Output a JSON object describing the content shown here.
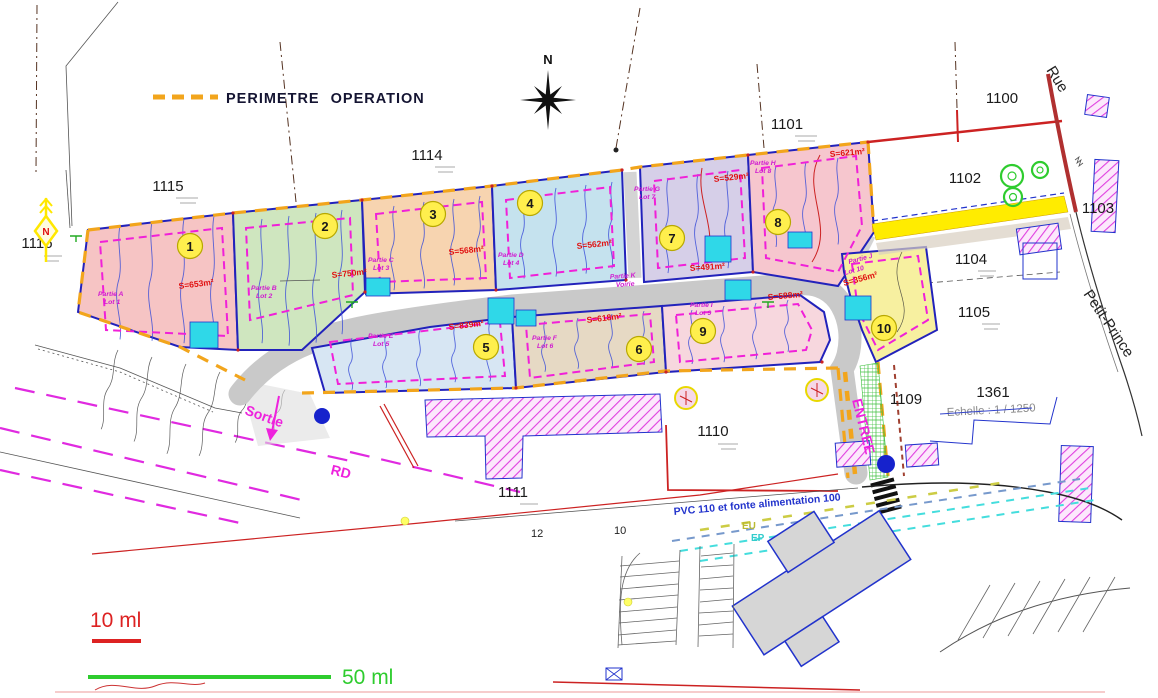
{
  "legend": {
    "label": "PERIMETRE OPERATION"
  },
  "compass": {
    "label": "N"
  },
  "north_marker": {
    "label": "N"
  },
  "scalebars": {
    "small": "10 ml",
    "large": "50 ml"
  },
  "texts": {
    "sortie": "Sortie",
    "entree": "ENTREE",
    "rd": "RD",
    "rue": "Rue",
    "petit_prince": "Petit-Prince",
    "pvc": "PVC 110 et fonte alimentation 100",
    "eu": "EU",
    "ep": "EP",
    "echelle": "Echelle : 1 / 1250",
    "n12": "12",
    "n10": "10"
  },
  "parcel_numbers": [
    "1115",
    "1116",
    "1114",
    "1101",
    "1100",
    "1102",
    "1103",
    "1104",
    "1105",
    "1361",
    "1109",
    "1110",
    "1111"
  ],
  "lots": [
    {
      "num": "1",
      "partie": "Partie A",
      "lot": "Lot 1",
      "area": "S=653m²",
      "color": "#f6c4c4"
    },
    {
      "num": "2",
      "partie": "Partie B",
      "lot": "Lot 2",
      "area": "S=750m²",
      "color": "#cfe6bf"
    },
    {
      "num": "3",
      "partie": "Partie C",
      "lot": "Lot 3",
      "area": "S=568m²",
      "color": "#f7d4b0"
    },
    {
      "num": "4",
      "partie": "Partie D",
      "lot": "Lot 4",
      "area": "S=562m²",
      "color": "#c5e2ee"
    },
    {
      "num": "5",
      "partie": "Partie E",
      "lot": "Lot 5",
      "area": "S=839m²",
      "color": "#d7e6f3"
    },
    {
      "num": "6",
      "partie": "Partie F",
      "lot": "Lot 6",
      "area": "S=618m²",
      "color": "#e6d9c4"
    },
    {
      "num": "7",
      "partie": "Partie G",
      "lot": "Lot 7",
      "area": "S=529m²",
      "color": "#d6cfe8"
    },
    {
      "num": "8",
      "partie": "Partie H",
      "lot": "Lot 8",
      "area": "S=621m²",
      "color": "#f6c6ce"
    },
    {
      "num": "9",
      "partie": "Partie I",
      "lot": "Lot 9",
      "area": "S=588m²",
      "color": "#f7d7de"
    },
    {
      "num": "10",
      "partie": "Partie J",
      "lot": "Lot 10",
      "area": "S=356m²",
      "color": "#f7f0a0"
    }
  ],
  "voirie": {
    "partie": "Partie K",
    "name": "Voirie",
    "area": "S=491m²"
  },
  "colors": {
    "perimeter_dash": "#f2a51c",
    "zone_dash": "#f020d8",
    "lot_outline": "#2222bb",
    "road_fill": "#c9c9c9",
    "scale_small": "#dd2222",
    "scale_large": "#2ecc2e",
    "yellow_road": "#ffec00",
    "tree_green": "#2ecc2e",
    "building_hatch": "#e040e0",
    "water_blue": "#1622cc"
  }
}
